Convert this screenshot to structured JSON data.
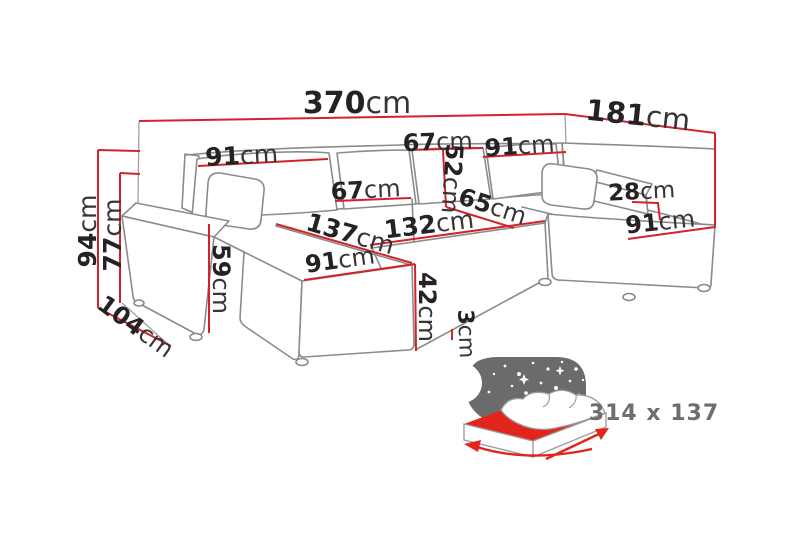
{
  "colors": {
    "dimension_red": "#d2232a",
    "outline_gray": "#8b8b8b",
    "helper_gray": "#9a9a9a",
    "text_black": "#262223",
    "icon_gray": "#6b6b6b",
    "icon_red": "#e1251b",
    "icon_text_gray": "#6d6e70"
  },
  "measurements": {
    "total_width": {
      "value": "370",
      "unit": "cm"
    },
    "right_depth": {
      "value": "181",
      "unit": "cm"
    },
    "back_left_width": {
      "value": "91",
      "unit": "cm"
    },
    "back_mid_left_width": {
      "value": "67",
      "unit": "cm"
    },
    "back_mid_right_width": {
      "value": "67",
      "unit": "cm"
    },
    "backrest_cushion_height": {
      "value": "52",
      "unit": "cm"
    },
    "back_right_width": {
      "value": "91",
      "unit": "cm"
    },
    "corner_armrest_height": {
      "value": "28",
      "unit": "cm"
    },
    "right_chaise_width": {
      "value": "91",
      "unit": "cm"
    },
    "seat_depth": {
      "value": "65",
      "unit": "cm"
    },
    "middle_seat_width": {
      "value": "132",
      "unit": "cm"
    },
    "left_chaise_length": {
      "value": "137",
      "unit": "cm"
    },
    "left_chaise_width": {
      "value": "91",
      "unit": "cm"
    },
    "seat_height": {
      "value": "42",
      "unit": "cm"
    },
    "leg_height": {
      "value": "3",
      "unit": "cm"
    },
    "total_height": {
      "value": "94",
      "unit": "cm"
    },
    "backrest_height": {
      "value": "77",
      "unit": "cm"
    },
    "left_depth": {
      "value": "104",
      "unit": "cm"
    },
    "armrest_height": {
      "value": "59",
      "unit": "cm"
    }
  },
  "sleeping_area": {
    "label": "314 x 137"
  }
}
